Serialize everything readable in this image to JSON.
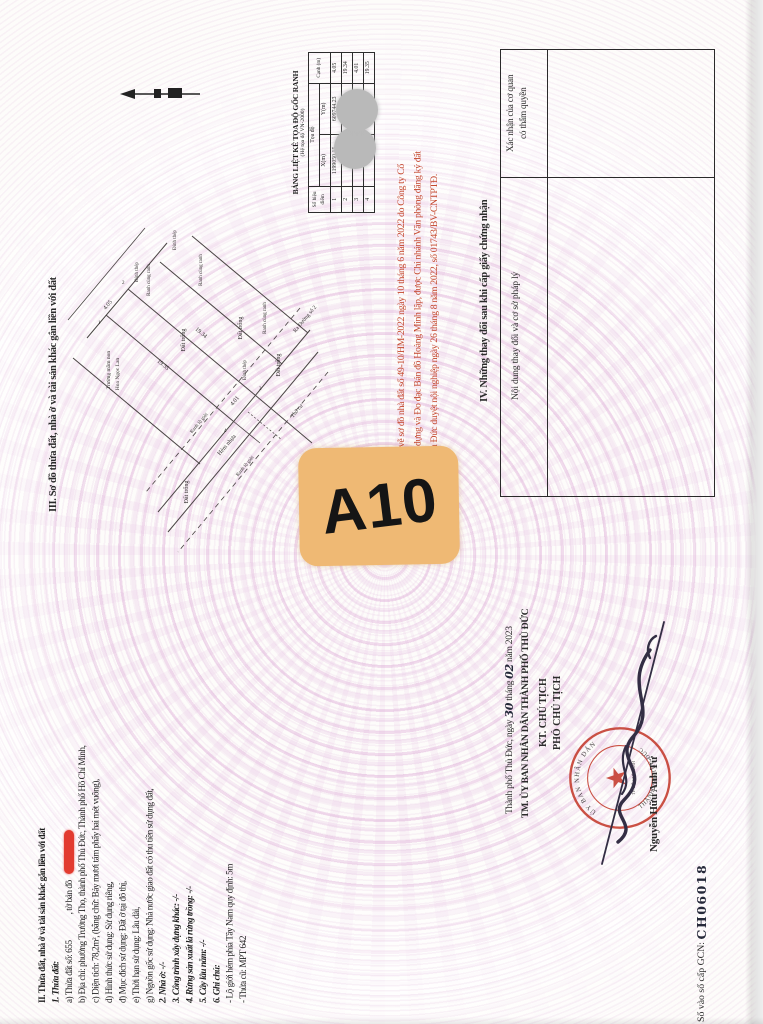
{
  "colors": {
    "badge_bg": "#efb974",
    "red_note": "#c4462c",
    "redaction_marker": "#e23b30",
    "stamp_red": "#c43a2c",
    "watermark_pink": "#deacd8",
    "ink": "#332e44"
  },
  "section3": {
    "title": "III. Sơ đồ thửa đất, nhà ở và tài sản khác gắn liền với đất"
  },
  "diagram": {
    "labels": {
      "dat_trong": "Đất trống",
      "ranh_cung_ranh": "Ranh cùng ranh",
      "dinh_thep": "Đinh thép",
      "truong_mam_non": "Trường mầm non",
      "hoa_ngoc_lan": "Hoa Ngọc Lan",
      "ranh_lo_gioi": "Ranh lộ giới",
      "hem_nhua": "Hẻm nhựa",
      "ra_duong": "Ra Đường số 2",
      "tho_cu": "Thổ cư"
    },
    "dims": {
      "top": "4.05",
      "right": "19.34",
      "left": "19.35",
      "bottom": "4.01"
    },
    "points": {
      "p1": "1",
      "p2": "2",
      "p3": "3",
      "p4": "4"
    }
  },
  "coord_table": {
    "title": "BẢNG LIỆT KÊ TỌA ĐỘ GỐC RANH",
    "subtitle": "(Hệ tọa độ VN-2000)",
    "col_point": "Số hiệu điểm",
    "col_coord": "Tọa độ",
    "col_x": "X(m)",
    "col_y": "Y(m)",
    "col_edge": "Cạnh (m)",
    "rows": [
      {
        "point": "1",
        "x": "1199050.15",
        "y": "609744.23",
        "edge": "4.05"
      },
      {
        "point": "2",
        "x": "",
        "y": "",
        "edge": "19.34"
      },
      {
        "point": "3",
        "x": "",
        "y": "",
        "edge": "4.01"
      },
      {
        "point": "4",
        "x": "",
        "y": "",
        "edge": "19.35"
      }
    ]
  },
  "red_note": {
    "line1": "Chi tiết theo Bản vẽ sơ đồ nhà đất số 49-10/HM-2022 ngày 10 tháng 6 năm 2022 do Công ty Cổ",
    "line2": "phần Đầu tư Xây dựng và Đo đạc Bản đồ Hoàng Minh lập, được Chi nhánh Văn phòng đăng ký đất",
    "line3": "đai thành phố Thủ Đức duyệt nội nghiệp ngày 26 tháng 8 năm 2022, số 01743/BV-CNTPTĐ."
  },
  "badge": {
    "label": "A10"
  },
  "section4": {
    "title": "IV. Những thay đổi sau khi cấp giấy chứng nhận",
    "col_confirm_1": "Xác nhận của cơ quan",
    "col_confirm_2": "có thẩm quyền",
    "col_content": "Nội dung thay đổi và cơ sở pháp lý"
  },
  "section2": {
    "title": "II. Thửa đất, nhà ở và tài sản khác gắn liền với đất",
    "sub1": "1. Thửa đất:",
    "a_pre": "a) Thửa đất số: 655",
    "a_post": ", tờ bản đồ",
    "b": "b) Địa chỉ: phường Trường Thọ, thành phố Thủ Đức, Thành phố Hồ Chí Minh,",
    "c": "c) Diện tích: 78,2m², (bằng chữ: Bảy mươi tám phẩy hai mét vuông),",
    "d": "d) Hình thức sử dụng: Sử dụng riêng,",
    "dd": "đ) Mục đích sử dụng: Đất ở tại đô thị,",
    "e": "e) Thời hạn sử dụng: Lâu dài,",
    "g": "g) Nguồn gốc sử dụng: Nhà nước giao đất có thu tiền sử dụng đất,",
    "n2": "2. Nhà ở: -/-",
    "n3": "3. Công trình xây dựng khác: -/-",
    "n4": "4. Rừng sản xuất là rừng trồng: -/-",
    "n5": "5. Cây lâu năm: -/-",
    "n6": "6. Ghi chú:",
    "note1": "- Lộ giới hẻm phía Tây Nam quy định: 5m",
    "note2": "- Thửa cũ: MPT 642"
  },
  "sign_block": {
    "place_prefix": "Thành phố Thủ Đức, ngày",
    "day": "30",
    "month_label": "tháng",
    "month": "02",
    "year_label": "năm 2023",
    "authority": "TM. ỦY BAN NHÂN DÂN THÀNH PHỐ THỦ ĐỨC",
    "kt": "KT. CHỦ TỊCH",
    "deputy": "PHÓ CHỦ TỊCH",
    "signer": "Nguyễn Hữu Anh Tứ",
    "stamp_line1": "ỦY BAN NHÂN DÂN",
    "stamp_line2": "THÀNH PHỐ THỦ ĐỨC",
    "stamp_line3": "TP. HỒ CHÍ MINH"
  },
  "footer": {
    "gcn_label": "Số vào sổ cấp GCN: ",
    "gcn_value": "CH06018"
  }
}
